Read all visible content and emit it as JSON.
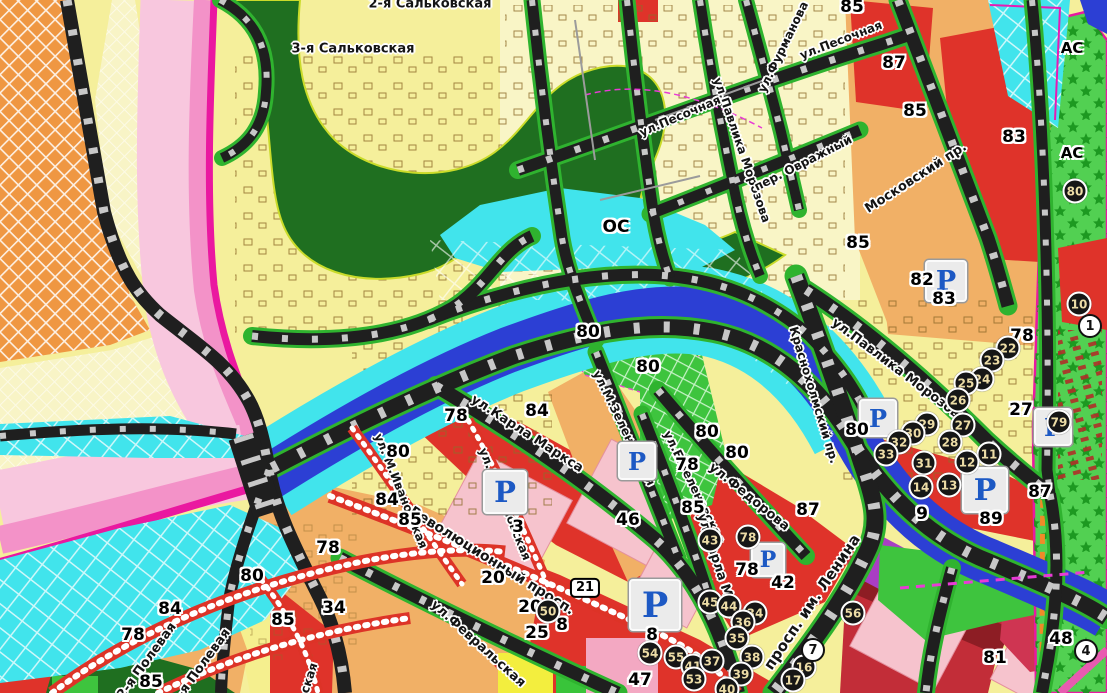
{
  "map": {
    "area_codes": [
      {
        "text": "ОС",
        "x": 616,
        "y": 227,
        "size": 17
      },
      {
        "text": "АС",
        "x": 1072,
        "y": 48,
        "size": 15
      },
      {
        "text": "АС",
        "x": 1072,
        "y": 153,
        "size": 15
      }
    ],
    "streets": [
      {
        "text": "3-я Сальковская",
        "x": 353,
        "y": 49,
        "rot": 0,
        "size": 13
      },
      {
        "text": "2-я Сальковская",
        "x": 430,
        "y": 4,
        "rot": 0,
        "size": 13
      },
      {
        "text": "ул.Песочная",
        "x": 841,
        "y": 40,
        "rot": -21,
        "size": 12
      },
      {
        "text": "ул.Фурманова",
        "x": 783,
        "y": 47,
        "rot": -64,
        "size": 12
      },
      {
        "text": "ул.Павлика Морозова",
        "x": 742,
        "y": 150,
        "rot": 71,
        "size": 12
      },
      {
        "text": "ул.Песочная",
        "x": 680,
        "y": 116,
        "rot": -23,
        "size": 12
      },
      {
        "text": "пер. Овражный",
        "x": 803,
        "y": 163,
        "rot": -27,
        "size": 12
      },
      {
        "text": "Московский пр.",
        "x": 916,
        "y": 178,
        "rot": -33,
        "size": 13
      },
      {
        "text": "ул.Павлика Морозова",
        "x": 899,
        "y": 371,
        "rot": 37,
        "size": 13
      },
      {
        "text": "Краснохолмский пр.",
        "x": 814,
        "y": 395,
        "rot": 73,
        "size": 12
      },
      {
        "text": "ул.Карла Маркса",
        "x": 527,
        "y": 434,
        "rot": 33,
        "size": 13
      },
      {
        "text": "ул.М.Зеленовская",
        "x": 624,
        "y": 428,
        "rot": 64,
        "size": 12
      },
      {
        "text": "ул.Б.Зеленовская",
        "x": 694,
        "y": 487,
        "rot": 64,
        "size": 12
      },
      {
        "text": "ул.Федорова",
        "x": 749,
        "y": 497,
        "rot": 39,
        "size": 13
      },
      {
        "text": "ул.Карла Маркса",
        "x": 721,
        "y": 576,
        "rot": 72,
        "size": 13
      },
      {
        "text": "просп. им. Ленина",
        "x": 812,
        "y": 602,
        "rot": -56,
        "size": 15
      },
      {
        "text": "Революционный просп.",
        "x": 492,
        "y": 561,
        "rot": 32,
        "size": 14
      },
      {
        "text": "ул.Февральская",
        "x": 478,
        "y": 644,
        "rot": 42,
        "size": 13
      },
      {
        "text": "ул. М.Ивановская",
        "x": 401,
        "y": 491,
        "rot": 68,
        "size": 12
      },
      {
        "text": "ул. Б.Ивановская",
        "x": 505,
        "y": 504,
        "rot": 68,
        "size": 12
      },
      {
        "text": "2-я Полевая",
        "x": 147,
        "y": 661,
        "rot": -54,
        "size": 13
      },
      {
        "text": "1-я Полевая",
        "x": 201,
        "y": 667,
        "rot": -54,
        "size": 13
      },
      {
        "text": "ская",
        "x": 309,
        "y": 678,
        "rot": -72,
        "size": 12
      }
    ],
    "plot_numbers": [
      {
        "text": "85",
        "x": 852,
        "y": 7
      },
      {
        "text": "87",
        "x": 894,
        "y": 63
      },
      {
        "text": "85",
        "x": 915,
        "y": 111
      },
      {
        "text": "83",
        "x": 1014,
        "y": 137
      },
      {
        "text": "85",
        "x": 858,
        "y": 243
      },
      {
        "text": "82",
        "x": 922,
        "y": 280
      },
      {
        "text": "83",
        "x": 944,
        "y": 299
      },
      {
        "text": "78",
        "x": 1022,
        "y": 336
      },
      {
        "text": "27",
        "x": 1021,
        "y": 410
      },
      {
        "text": "80",
        "x": 588,
        "y": 332
      },
      {
        "text": "80",
        "x": 648,
        "y": 367
      },
      {
        "text": "80",
        "x": 707,
        "y": 432
      },
      {
        "text": "80",
        "x": 737,
        "y": 453
      },
      {
        "text": "80",
        "x": 857,
        "y": 430
      },
      {
        "text": "78",
        "x": 456,
        "y": 416
      },
      {
        "text": "84",
        "x": 537,
        "y": 411
      },
      {
        "text": "80",
        "x": 398,
        "y": 452
      },
      {
        "text": "84",
        "x": 387,
        "y": 500
      },
      {
        "text": "85",
        "x": 410,
        "y": 520
      },
      {
        "text": "78",
        "x": 328,
        "y": 548
      },
      {
        "text": "3",
        "x": 518,
        "y": 527
      },
      {
        "text": "20",
        "x": 493,
        "y": 578
      },
      {
        "text": "20",
        "x": 530,
        "y": 607
      },
      {
        "text": "8",
        "x": 562,
        "y": 625
      },
      {
        "text": "25",
        "x": 537,
        "y": 633
      },
      {
        "text": "46",
        "x": 628,
        "y": 520
      },
      {
        "text": "85",
        "x": 693,
        "y": 508
      },
      {
        "text": "78",
        "x": 687,
        "y": 465
      },
      {
        "text": "87",
        "x": 808,
        "y": 510
      },
      {
        "text": "42",
        "x": 783,
        "y": 583
      },
      {
        "text": "78",
        "x": 747,
        "y": 570
      },
      {
        "text": "8",
        "x": 652,
        "y": 635
      },
      {
        "text": "47",
        "x": 640,
        "y": 680
      },
      {
        "text": "34",
        "x": 334,
        "y": 608
      },
      {
        "text": "9",
        "x": 922,
        "y": 514
      },
      {
        "text": "89",
        "x": 991,
        "y": 519
      },
      {
        "text": "87",
        "x": 1040,
        "y": 492
      },
      {
        "text": "81",
        "x": 995,
        "y": 658
      },
      {
        "text": "48",
        "x": 1061,
        "y": 639
      },
      {
        "text": "80",
        "x": 252,
        "y": 576
      },
      {
        "text": "84",
        "x": 170,
        "y": 609
      },
      {
        "text": "78",
        "x": 133,
        "y": 635
      },
      {
        "text": "85",
        "x": 151,
        "y": 682
      },
      {
        "text": "85",
        "x": 283,
        "y": 620
      }
    ],
    "markers_dark": [
      {
        "text": "22",
        "x": 1008,
        "y": 348
      },
      {
        "text": "23",
        "x": 992,
        "y": 360
      },
      {
        "text": "24",
        "x": 982,
        "y": 379
      },
      {
        "text": "25",
        "x": 966,
        "y": 383
      },
      {
        "text": "26",
        "x": 958,
        "y": 400
      },
      {
        "text": "27",
        "x": 963,
        "y": 425
      },
      {
        "text": "28",
        "x": 950,
        "y": 442
      },
      {
        "text": "29",
        "x": 927,
        "y": 424
      },
      {
        "text": "30",
        "x": 913,
        "y": 433
      },
      {
        "text": "31",
        "x": 924,
        "y": 463
      },
      {
        "text": "32",
        "x": 899,
        "y": 442
      },
      {
        "text": "33",
        "x": 886,
        "y": 454
      },
      {
        "text": "11",
        "x": 989,
        "y": 454
      },
      {
        "text": "12",
        "x": 967,
        "y": 462
      },
      {
        "text": "13",
        "x": 949,
        "y": 485
      },
      {
        "text": "14",
        "x": 921,
        "y": 487
      },
      {
        "text": "10",
        "x": 1079,
        "y": 304
      },
      {
        "text": "80",
        "x": 1075,
        "y": 191
      },
      {
        "text": "79",
        "x": 1059,
        "y": 422
      },
      {
        "text": "43",
        "x": 710,
        "y": 540
      },
      {
        "text": "78",
        "x": 748,
        "y": 537
      },
      {
        "text": "45",
        "x": 710,
        "y": 602
      },
      {
        "text": "44",
        "x": 729,
        "y": 606
      },
      {
        "text": "34",
        "x": 755,
        "y": 613
      },
      {
        "text": "36",
        "x": 743,
        "y": 622
      },
      {
        "text": "35",
        "x": 737,
        "y": 638
      },
      {
        "text": "38",
        "x": 752,
        "y": 657
      },
      {
        "text": "39",
        "x": 741,
        "y": 674
      },
      {
        "text": "40",
        "x": 727,
        "y": 689
      },
      {
        "text": "54",
        "x": 650,
        "y": 653
      },
      {
        "text": "55",
        "x": 676,
        "y": 657
      },
      {
        "text": "41",
        "x": 693,
        "y": 666
      },
      {
        "text": "37",
        "x": 712,
        "y": 661
      },
      {
        "text": "53",
        "x": 694,
        "y": 679
      },
      {
        "text": "56",
        "x": 853,
        "y": 613
      },
      {
        "text": "50",
        "x": 548,
        "y": 611
      },
      {
        "text": "16",
        "x": 804,
        "y": 667
      },
      {
        "text": "17",
        "x": 793,
        "y": 680
      }
    ],
    "markers_light": [
      {
        "text": "1",
        "x": 1090,
        "y": 326
      },
      {
        "text": "7",
        "x": 813,
        "y": 650
      },
      {
        "text": "4",
        "x": 1086,
        "y": 651
      }
    ],
    "route_shield": {
      "text": "21",
      "x": 585,
      "y": 588
    },
    "parking": {
      "glyph": "Р",
      "spots": [
        {
          "x": 946,
          "y": 281,
          "size": 38
        },
        {
          "x": 878,
          "y": 418,
          "size": 34
        },
        {
          "x": 985,
          "y": 490,
          "size": 42
        },
        {
          "x": 637,
          "y": 461,
          "size": 34
        },
        {
          "x": 505,
          "y": 492,
          "size": 40
        },
        {
          "x": 768,
          "y": 560,
          "size": 30
        },
        {
          "x": 655,
          "y": 605,
          "size": 48
        },
        {
          "x": 1053,
          "y": 427,
          "size": 34
        }
      ]
    },
    "colors": {
      "river": "#2c3fd4",
      "floodplain": "#41e4ec",
      "forest": "#1f6f20",
      "park": "#3ec43e",
      "strip_green": "#52d052",
      "red_zone": "#df332a",
      "residential_tan": "#f1b066",
      "housing_yellow": "#f5ef9b",
      "industrial_orange": "#ef9742",
      "rail_pink": "#f8c7de",
      "rail_magenta": "#ea18a0",
      "road": "#1f1f1f",
      "planned_road": "#dd3327",
      "parking_blue": "#1d59c4"
    }
  }
}
